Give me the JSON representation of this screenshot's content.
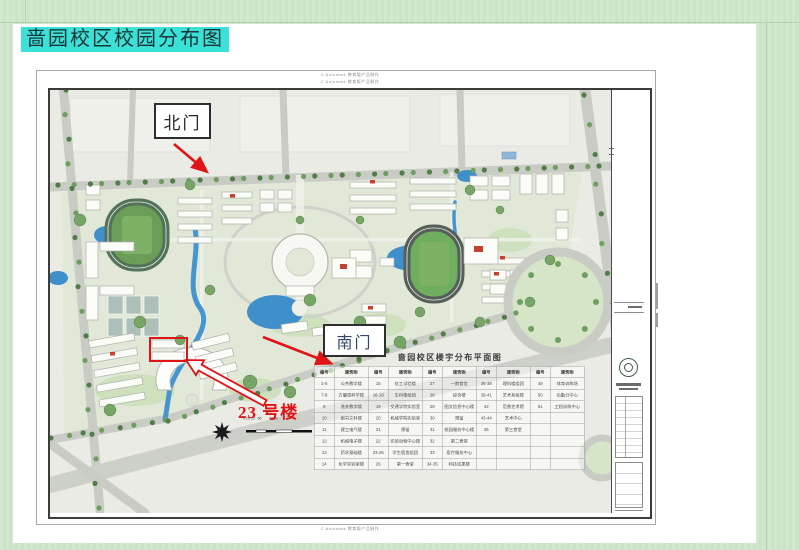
{
  "slide": {
    "title": "啬园校区校园分布图"
  },
  "annotations": {
    "north_gate": "北门",
    "south_gate": "南门",
    "building_23": "23 号楼",
    "arrow_color": "#e01414"
  },
  "drawing": {
    "watermark_top_1": "C Autodesk 教育版产品制作",
    "watermark_top_2": "C Autodesk 教育版产品制作",
    "watermark_bottom": "C Autodesk 教育版产品制作",
    "scale_label": "0 10 20   50        100m",
    "legend": {
      "title": "啬园校区楼宇分布平面图",
      "columns": [
        "编号",
        "建筑物",
        "编号",
        "建筑物",
        "编号",
        "建筑物",
        "编号",
        "建筑物",
        "编号",
        "建筑物"
      ],
      "rows": [
        [
          "1-6",
          "公共教学楼",
          "15",
          "化工试验楼",
          "27",
          "一期食堂",
          "36-38",
          "理科楼组团",
          "49",
          "体育训练场"
        ],
        [
          "7-8",
          "方肇周科学楼",
          "16-18",
          "生科楼组团",
          "28",
          "综合楼",
          "39-41",
          "艺术系组楼",
          "50",
          "后勤分中心"
        ],
        [
          "9",
          "逸夫教学楼",
          "19",
          "交通学院实验室",
          "29",
          "图文信息中心楼",
          "42",
          "范曾艺术馆",
          "51",
          "工程训练中心"
        ],
        [
          "10",
          "图书文科楼",
          "20",
          "机械学院实验室",
          "30",
          "预留",
          "43-44",
          "艺术中心",
          "",
          ""
        ],
        [
          "11",
          "建工电气楼",
          "21",
          "预留",
          "31",
          "校园服务中心楼",
          "45",
          "第三食堂",
          "",
          ""
        ],
        [
          "12",
          "机械电子楼",
          "22",
          "实验动物中心楼",
          "32",
          "第二食堂",
          "",
          "",
          "",
          ""
        ],
        [
          "13",
          "药学基础楼",
          "23-25",
          "学生宿舍组团",
          "33",
          "医疗服务中心",
          "",
          "",
          "",
          ""
        ],
        [
          "14",
          "化学实验室楼",
          "26",
          "第一食堂",
          "34-35",
          "科技成果楼",
          "",
          "",
          "",
          ""
        ]
      ]
    }
  }
}
